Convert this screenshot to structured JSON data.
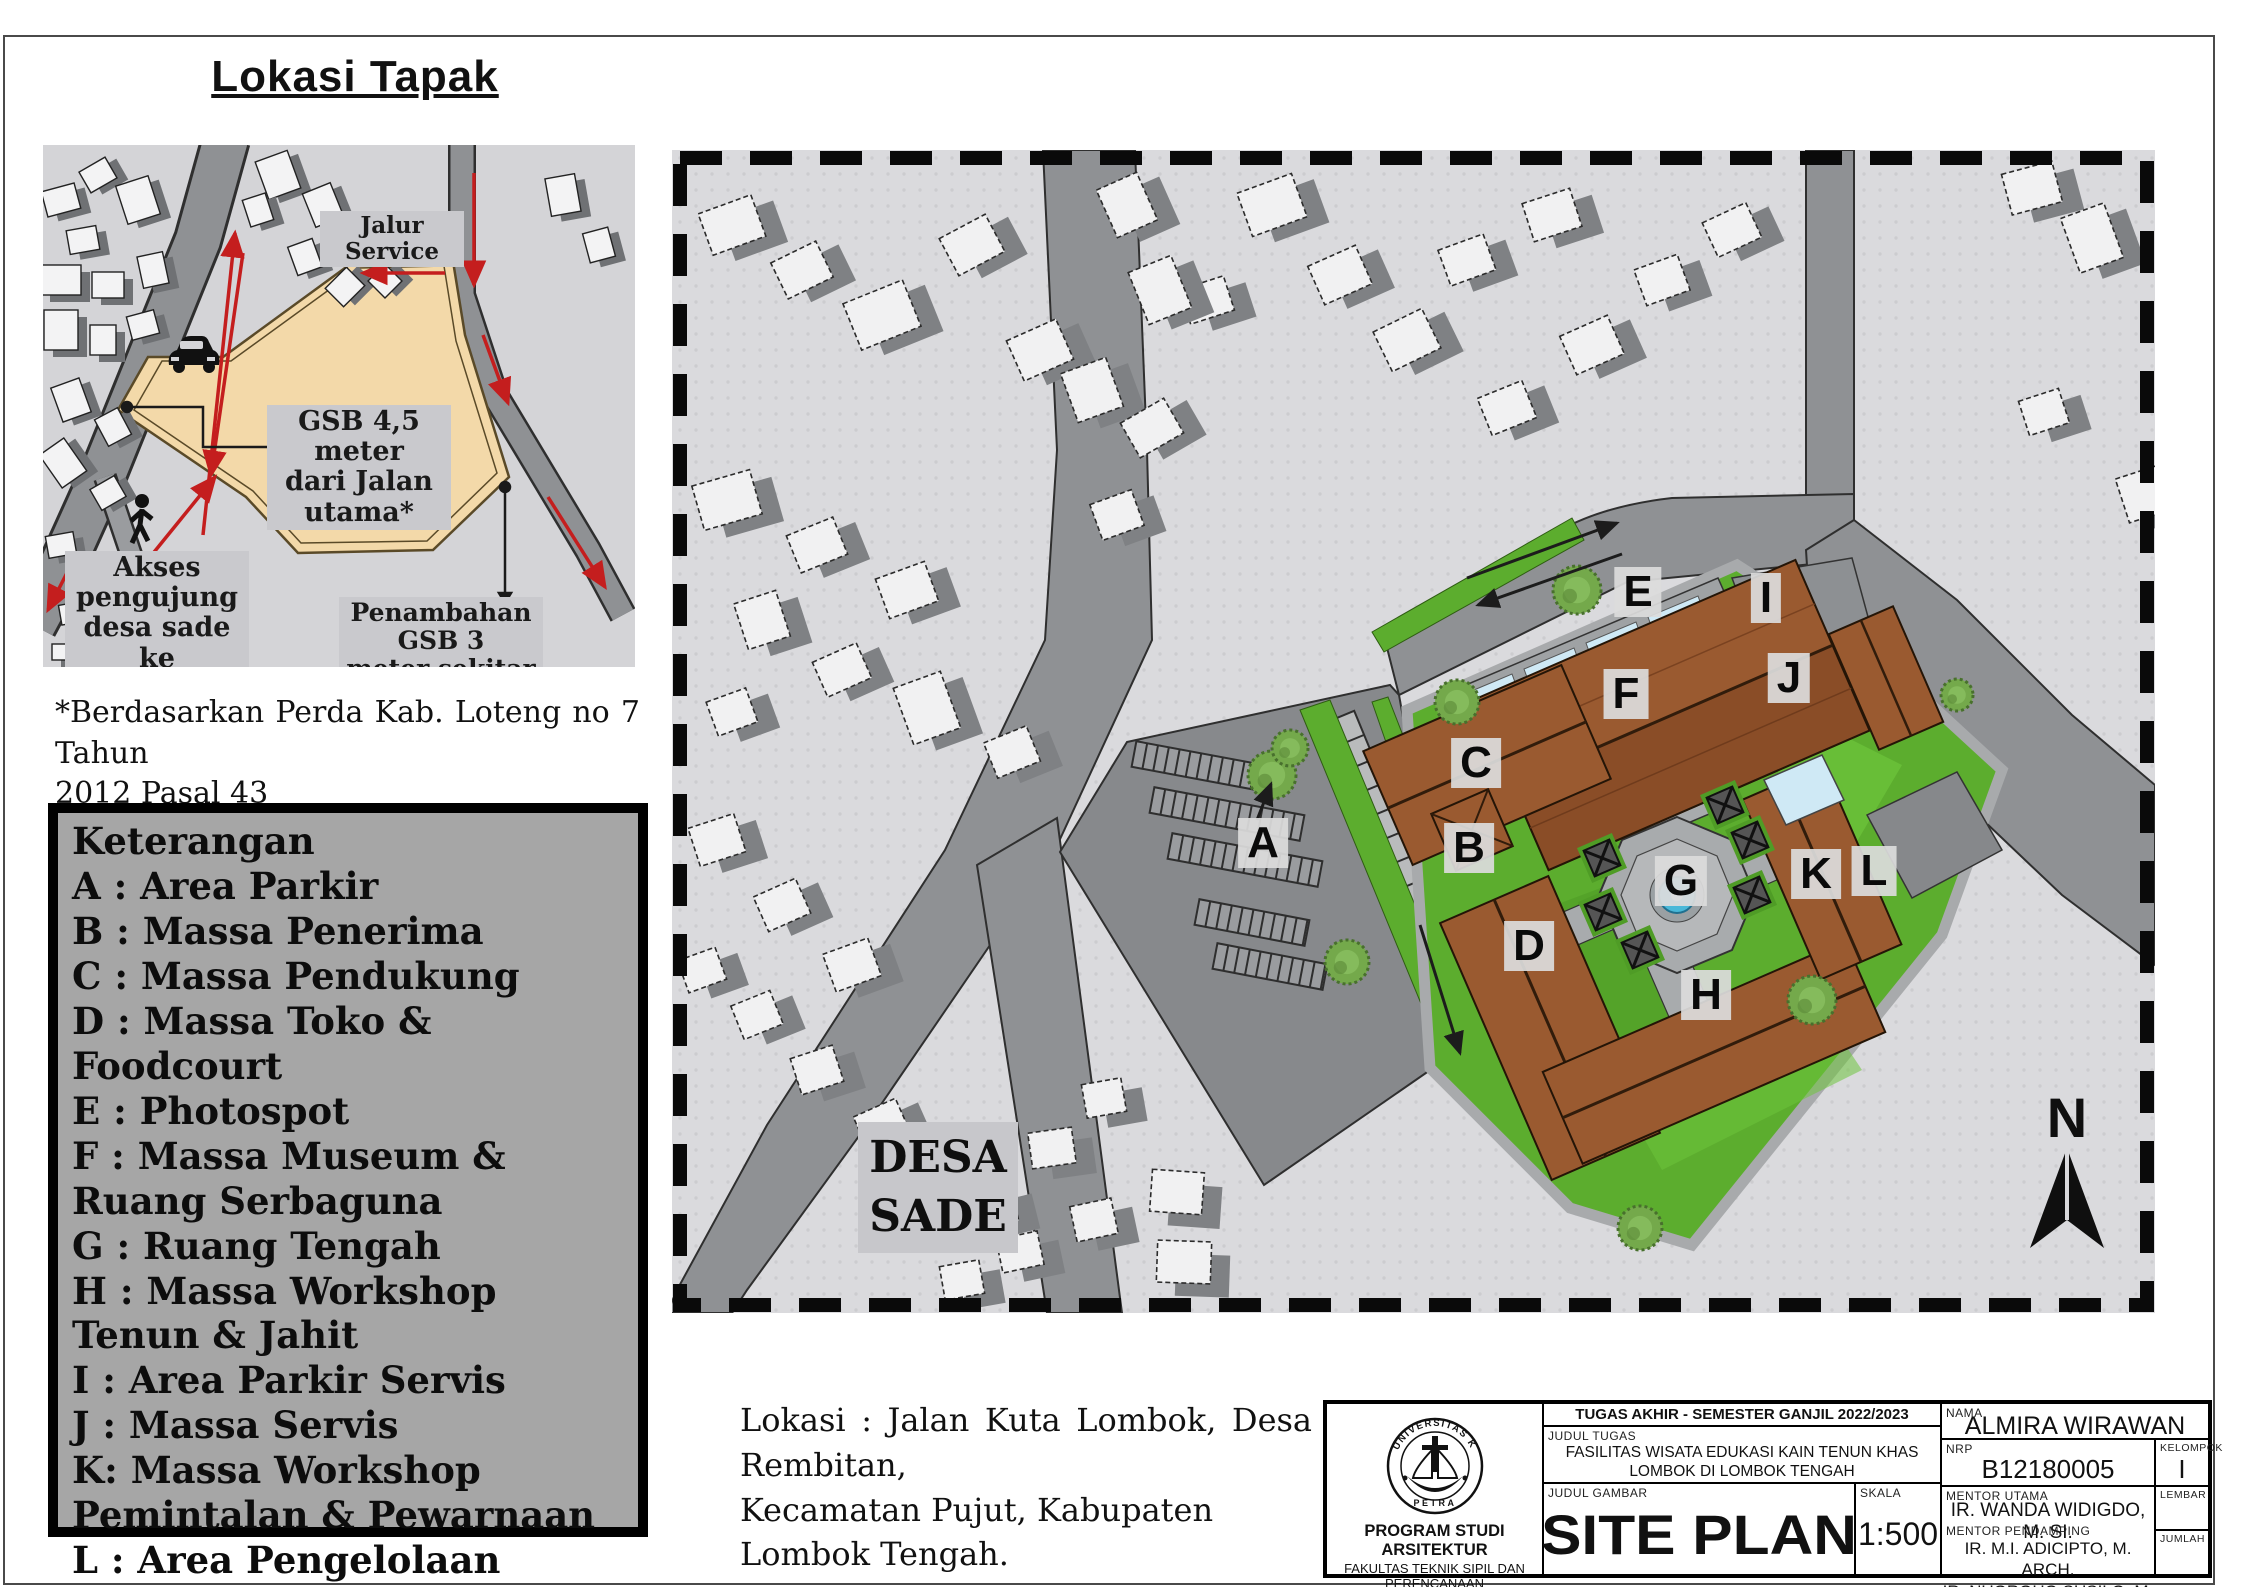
{
  "page": {
    "title": "Lokasi Tapak",
    "footnote_lines": [
      "*Berdasarkan Perda Kab. Loteng no 7 Tahun",
      "2012 Pasal 43"
    ],
    "lokasi_lines": [
      "Lokasi : Jalan Kuta Lombok, Desa Rembitan,",
      "Kecamatan Pujut, Kabupaten Lombok Tengah."
    ]
  },
  "inset": {
    "jalur_service": "Jalur Service",
    "gsb_lines": [
      "GSB 4,5 meter",
      "dari Jalan utama*"
    ],
    "akses_lines": [
      "Akses pengujung",
      "desa sade ke",
      "tapak"
    ],
    "penambahan_lines": [
      "Penambahan GSB 3",
      "meter sekitar tapak"
    ]
  },
  "legend": {
    "title": "Keterangan",
    "items": [
      "A : Area Parkir",
      "B : Massa Penerima",
      "C : Massa Pendukung",
      "D : Massa Toko & Foodcourt",
      "E : Photospot",
      "F : Massa Museum & Ruang Serbaguna",
      "G : Ruang Tengah",
      "H : Massa Workshop Tenun & Jahit",
      "I : Area Parkir Servis",
      "J : Massa Servis",
      "K: Massa Workshop Pemintalan & Pewarnaan",
      "L : Area Pengelolaan Limbah"
    ]
  },
  "map": {
    "desa_sade_lines": [
      "DESA",
      "SADE"
    ],
    "north_label": "N",
    "site_labels": [
      "A",
      "B",
      "C",
      "D",
      "E",
      "F",
      "G",
      "H",
      "I",
      "J",
      "K",
      "L"
    ]
  },
  "titleblock": {
    "header": "TUGAS AKHIR - SEMESTER GANJIL 2022/2023",
    "judul_tugas_label": "JUDUL TUGAS",
    "judul_tugas_lines": [
      "FASILITAS WISATA EDUKASI KAIN TENUN KHAS",
      "LOMBOK DI LOMBOK TENGAH"
    ],
    "judul_gambar_label": "JUDUL GAMBAR",
    "judul_gambar": "SITE PLAN",
    "skala_label": "SKALA",
    "skala": "1:500",
    "nama_label": "NAMA",
    "nama": "ALMIRA WIRAWAN",
    "nrp_label": "NRP",
    "nrp": "B12180005",
    "kelompok_label": "KELOMPOK",
    "kelompok": "I",
    "mentor_utama_label": "MENTOR UTAMA",
    "mentor_utama": "IR. WANDA WIDIGDO,  M. SI.",
    "mentor_pendamping_label": "MENTOR PENDAMPING",
    "mentor_pendamping": [
      "IR. M.I. ADICIPTO, M. ARCH.",
      "IR. NUGROHO SUSILO, M. BDG. SC."
    ],
    "lembar_label": "LEMBAR",
    "jumlah_label": "JUMLAH",
    "logo_top_text": "UNIVERSITAS KRISTEN",
    "logo_bottom_text": "PETRA",
    "program_lines": [
      "PROGRAM STUDI ARSITEKTUR",
      "FAKULTAS TEKNIK SIPIL DAN PERENCANAAN",
      "UNIVERSITAS KRISTEN PETRA",
      "SURABAYA"
    ]
  },
  "colors": {
    "accent_red": "#c41e1e",
    "site_beige": "#f3d9a9",
    "roof_brown": "#9a5a30",
    "lawn_green": "#5cad2e",
    "road_gray": "#8f9194",
    "map_bg": "#dadadd"
  }
}
